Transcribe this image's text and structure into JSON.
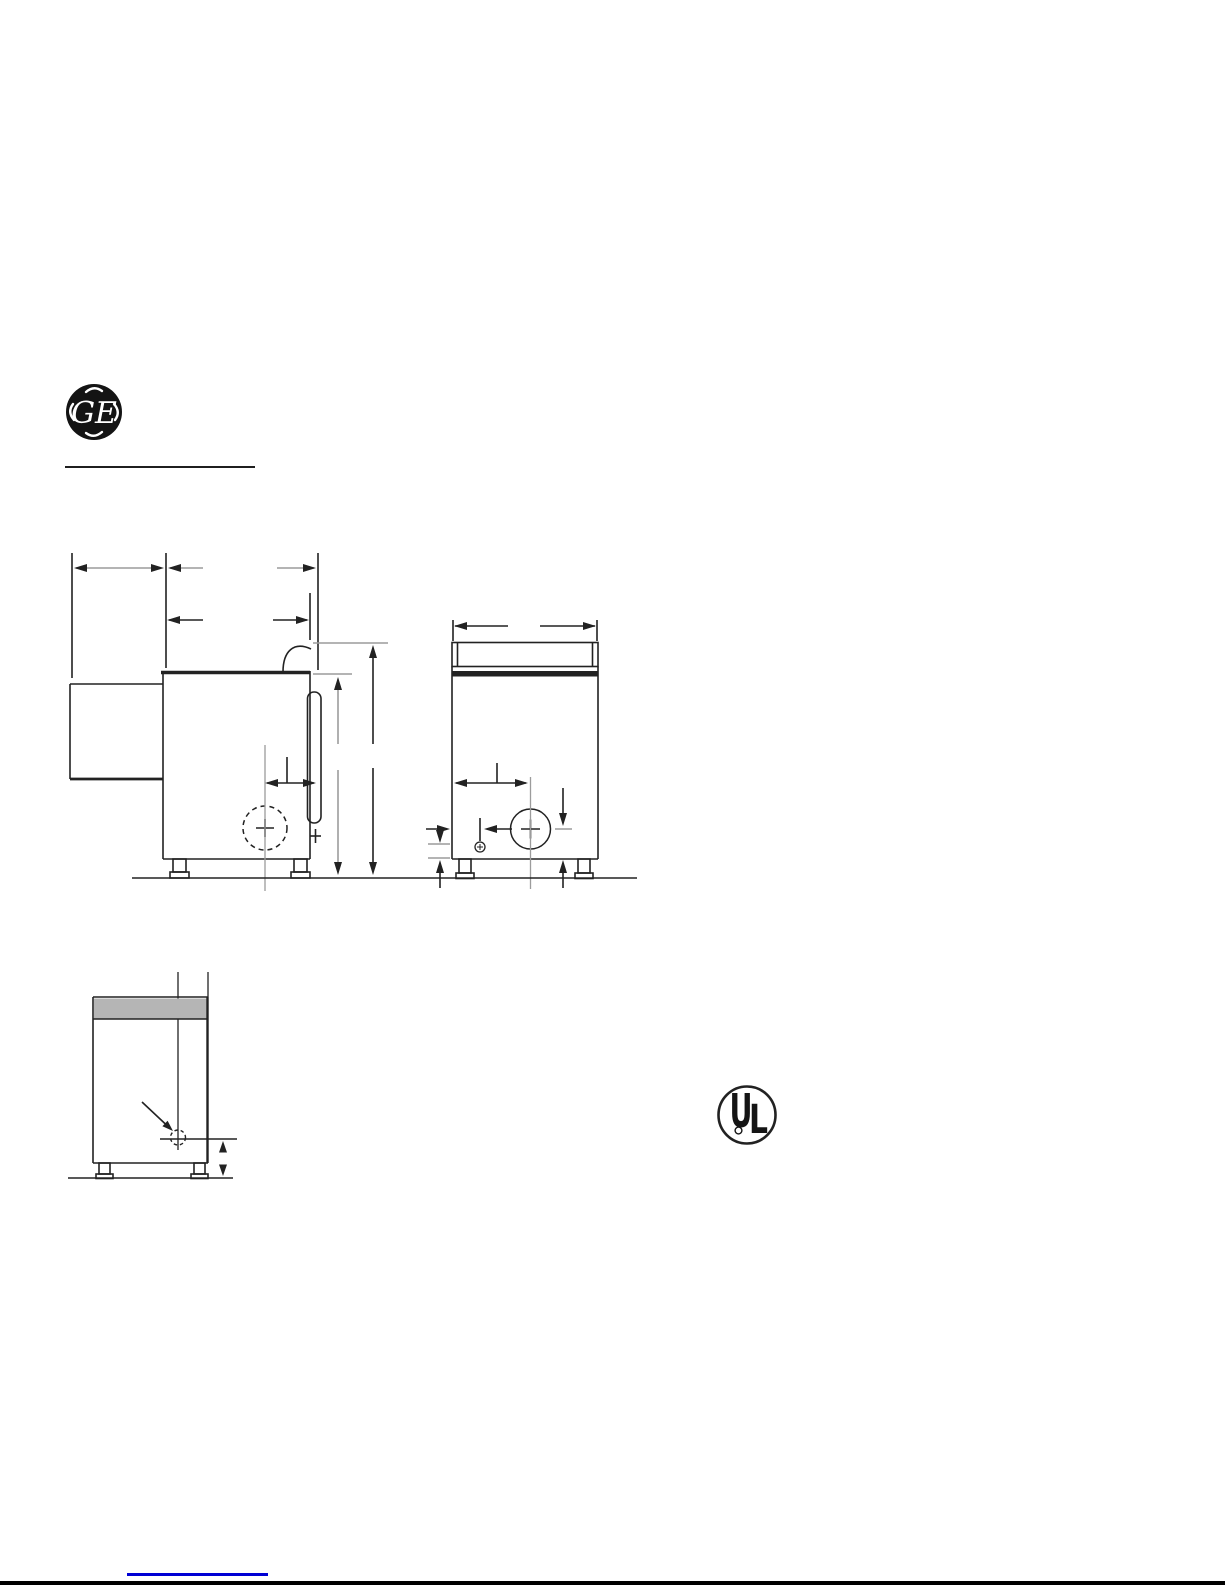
{
  "page": {
    "width": 1225,
    "height": 1585,
    "background": "#ffffff"
  },
  "colors": {
    "ink": "#222222",
    "gray_line": "#9c9c9c",
    "band_fill": "#b5b5b5",
    "link_blue": "#0000d4",
    "logo_black": "#141414",
    "white": "#ffffff"
  },
  "header": {
    "ge_monogram_letters": "GE"
  },
  "certification": {
    "ul_letter_u": "U",
    "ul_letter_l": "L"
  },
  "drawing": {
    "views": [
      {
        "name": "side-view",
        "shapes": [
          {
            "t": "l",
            "x1": 72,
            "y1": 553,
            "x2": 72,
            "y2": 678
          },
          {
            "t": "l",
            "x1": 166,
            "y1": 553,
            "x2": 166,
            "y2": 668
          },
          {
            "t": "l",
            "x1": 318,
            "y1": 553,
            "x2": 318,
            "y2": 670
          },
          {
            "t": "l",
            "x1": 310,
            "y1": 593,
            "x2": 310,
            "y2": 640
          },
          {
            "t": "l",
            "x1": 76,
            "y1": 568,
            "x2": 160,
            "y2": 568,
            "c": "g"
          },
          {
            "t": "a",
            "x": 74,
            "y": 568,
            "dir": "left"
          },
          {
            "t": "a",
            "x": 164,
            "y": 568,
            "dir": "right"
          },
          {
            "t": "l",
            "x1": 170,
            "y1": 568,
            "x2": 203,
            "y2": 568,
            "c": "g"
          },
          {
            "t": "l",
            "x1": 277,
            "y1": 568,
            "x2": 314,
            "y2": 568,
            "c": "g"
          },
          {
            "t": "a",
            "x": 168,
            "y": 568,
            "dir": "left"
          },
          {
            "t": "a",
            "x": 316,
            "y": 568,
            "dir": "right"
          },
          {
            "t": "l",
            "x1": 169,
            "y1": 620,
            "x2": 203,
            "y2": 620
          },
          {
            "t": "l",
            "x1": 273,
            "y1": 620,
            "x2": 307,
            "y2": 620
          },
          {
            "t": "a",
            "x": 167,
            "y": 620,
            "dir": "left"
          },
          {
            "t": "a",
            "x": 309,
            "y": 620,
            "dir": "right"
          },
          {
            "t": "l",
            "x1": 161,
            "y1": 672.5,
            "x2": 310,
            "y2": 672.5,
            "w": 3.4,
            "n": "cabinet-top"
          },
          {
            "t": "l",
            "x1": 163,
            "y1": 671,
            "x2": 163,
            "y2": 859,
            "n": "cabinet-rear-edge"
          },
          {
            "t": "l",
            "x1": 163,
            "y1": 859,
            "x2": 310,
            "y2": 859,
            "n": "cabinet-bottom"
          },
          {
            "t": "l",
            "x1": 310,
            "y1": 671,
            "x2": 310,
            "y2": 859,
            "n": "cabinet-front-edge"
          },
          {
            "t": "l",
            "x1": 70,
            "y1": 684,
            "x2": 163,
            "y2": 684,
            "n": "rear-duct-top"
          },
          {
            "t": "l",
            "x1": 70,
            "y1": 684,
            "x2": 70,
            "y2": 779,
            "n": "rear-duct-left"
          },
          {
            "t": "l",
            "x1": 70,
            "y1": 779,
            "x2": 163,
            "y2": 779,
            "w": 2.8,
            "n": "rear-duct-bottom"
          },
          {
            "t": "p",
            "d": "M 283 672 C 283 651 294 641 311 649",
            "n": "console-profile-arc"
          },
          {
            "t": "r",
            "x": 307.5,
            "y": 692,
            "wd": 13.5,
            "ht": 131,
            "rx": 6.5,
            "n": "door-side-profile"
          },
          {
            "t": "c",
            "cx": 265,
            "cy": 828,
            "r": 22,
            "d": "5 4",
            "n": "exhaust-outlet-dashed-circle"
          },
          {
            "t": "l",
            "x1": 256,
            "y1": 828,
            "x2": 274,
            "y2": 828
          },
          {
            "t": "l",
            "x1": 265,
            "y1": 819,
            "x2": 265,
            "y2": 837
          },
          {
            "t": "l",
            "x1": 265,
            "y1": 745,
            "x2": 265,
            "y2": 891,
            "c": "g",
            "w": 1.3,
            "n": "exhaust-centerline"
          },
          {
            "t": "l",
            "x1": 267,
            "y1": 783,
            "x2": 314,
            "y2": 783
          },
          {
            "t": "a",
            "x": 265,
            "y": 783,
            "dir": "left"
          },
          {
            "t": "a",
            "x": 316,
            "y": 783,
            "dir": "right"
          },
          {
            "t": "l",
            "x1": 287,
            "y1": 757,
            "x2": 287,
            "y2": 783
          },
          {
            "t": "l",
            "x1": 313,
            "y1": 643,
            "x2": 388,
            "y2": 643,
            "c": "g"
          },
          {
            "t": "l",
            "x1": 313,
            "y1": 674,
            "x2": 352,
            "y2": 674,
            "c": "g"
          },
          {
            "t": "l",
            "x1": 338,
            "y1": 688,
            "x2": 338,
            "y2": 744,
            "c": "g"
          },
          {
            "t": "l",
            "x1": 338,
            "y1": 770,
            "x2": 338,
            "y2": 862,
            "c": "g"
          },
          {
            "t": "a",
            "x": 338,
            "y": 677,
            "dir": "up"
          },
          {
            "t": "a",
            "x": 338,
            "y": 875,
            "dir": "down"
          },
          {
            "t": "l",
            "x1": 373,
            "y1": 656,
            "x2": 373,
            "y2": 744
          },
          {
            "t": "l",
            "x1": 373,
            "y1": 768,
            "x2": 373,
            "y2": 862
          },
          {
            "t": "a",
            "x": 373,
            "y": 645,
            "dir": "up"
          },
          {
            "t": "a",
            "x": 373,
            "y": 875,
            "dir": "down"
          },
          {
            "t": "r",
            "x": 173,
            "y": 859,
            "wd": 13,
            "ht": 13,
            "n": "leg"
          },
          {
            "t": "r",
            "x": 170,
            "y": 872,
            "wd": 19,
            "ht": 6,
            "n": "leg-foot"
          },
          {
            "t": "r",
            "x": 294,
            "y": 859,
            "wd": 13,
            "ht": 13,
            "n": "leg"
          },
          {
            "t": "r",
            "x": 291,
            "y": 872,
            "wd": 19,
            "ht": 6,
            "n": "leg-foot"
          },
          {
            "t": "l",
            "x1": 310,
            "y1": 836,
            "x2": 321,
            "y2": 836,
            "n": "gas-stub"
          },
          {
            "t": "l",
            "x1": 315.5,
            "y1": 829,
            "x2": 315.5,
            "y2": 843,
            "n": "gas-stub"
          }
        ]
      },
      {
        "name": "front-view",
        "shapes": [
          {
            "t": "l",
            "x1": 453,
            "y1": 620,
            "x2": 453,
            "y2": 641
          },
          {
            "t": "l",
            "x1": 597,
            "y1": 620,
            "x2": 597,
            "y2": 641
          },
          {
            "t": "l",
            "x1": 455,
            "y1": 626,
            "x2": 508,
            "y2": 626
          },
          {
            "t": "l",
            "x1": 540,
            "y1": 626,
            "x2": 595,
            "y2": 626
          },
          {
            "t": "a",
            "x": 454,
            "y": 626,
            "dir": "left"
          },
          {
            "t": "a",
            "x": 596,
            "y": 626,
            "dir": "right"
          },
          {
            "t": "r",
            "x": 452,
            "y": 642.5,
            "wd": 146,
            "ht": 24,
            "n": "backsplash"
          },
          {
            "t": "l",
            "x1": 457.5,
            "y1": 643,
            "x2": 457.5,
            "y2": 666
          },
          {
            "t": "l",
            "x1": 592.5,
            "y1": 643,
            "x2": 592.5,
            "y2": 666
          },
          {
            "t": "r",
            "x": 452,
            "y": 671,
            "wd": 146,
            "ht": 5.5,
            "fill": "ink",
            "n": "top-edge-band"
          },
          {
            "t": "l",
            "x1": 452,
            "y1": 666.5,
            "x2": 452,
            "y2": 859,
            "n": "cabinet-left-edge"
          },
          {
            "t": "l",
            "x1": 598,
            "y1": 666.5,
            "x2": 598,
            "y2": 859,
            "n": "cabinet-right-edge"
          },
          {
            "t": "l",
            "x1": 452,
            "y1": 859,
            "x2": 598,
            "y2": 859,
            "n": "cabinet-bottom"
          },
          {
            "t": "l",
            "x1": 456,
            "y1": 783,
            "x2": 526,
            "y2": 783
          },
          {
            "t": "a",
            "x": 454,
            "y": 783,
            "dir": "left"
          },
          {
            "t": "a",
            "x": 528,
            "y": 783,
            "dir": "right"
          },
          {
            "t": "l",
            "x1": 497,
            "y1": 763,
            "x2": 497,
            "y2": 783
          },
          {
            "t": "c",
            "cx": 530.5,
            "cy": 829,
            "r": 20,
            "n": "exhaust-outlet-circle"
          },
          {
            "t": "l",
            "x1": 521,
            "y1": 829,
            "x2": 540,
            "y2": 829
          },
          {
            "t": "l",
            "x1": 530.5,
            "y1": 819.5,
            "x2": 530.5,
            "y2": 838.5
          },
          {
            "t": "l",
            "x1": 530.5,
            "y1": 777,
            "x2": 530.5,
            "y2": 889,
            "c": "g",
            "w": 1.3,
            "n": "center-line"
          },
          {
            "t": "l",
            "x1": 563,
            "y1": 788,
            "x2": 563,
            "y2": 815
          },
          {
            "t": "a",
            "x": 563,
            "y": 826,
            "dir": "down"
          },
          {
            "t": "l",
            "x1": 555,
            "y1": 829,
            "x2": 572,
            "y2": 829,
            "c": "g"
          },
          {
            "t": "l",
            "x1": 487,
            "y1": 829,
            "x2": 512,
            "y2": 829
          },
          {
            "t": "a",
            "x": 484,
            "y": 829,
            "dir": "left"
          },
          {
            "t": "l",
            "x1": 480,
            "y1": 818,
            "x2": 480,
            "y2": 841
          },
          {
            "t": "c",
            "cx": 480,
            "cy": 847,
            "r": 5,
            "w": 1.3,
            "n": "gas-connection-circle"
          },
          {
            "t": "l",
            "x1": 477,
            "y1": 847,
            "x2": 483,
            "y2": 847,
            "w": 1
          },
          {
            "t": "l",
            "x1": 480,
            "y1": 844,
            "x2": 480,
            "y2": 850,
            "w": 1
          },
          {
            "t": "l",
            "x1": 426,
            "y1": 829,
            "x2": 447,
            "y2": 829
          },
          {
            "t": "a",
            "x": 450,
            "y": 829,
            "dir": "right"
          },
          {
            "t": "l",
            "x1": 428,
            "y1": 844,
            "x2": 450,
            "y2": 844,
            "c": "g"
          },
          {
            "t": "l",
            "x1": 440,
            "y1": 830,
            "x2": 440,
            "y2": 834
          },
          {
            "t": "a",
            "x": 440,
            "y": 843,
            "dir": "down"
          },
          {
            "t": "l",
            "x1": 428,
            "y1": 858,
            "x2": 450,
            "y2": 858,
            "c": "g"
          },
          {
            "t": "l",
            "x1": 440,
            "y1": 888,
            "x2": 440,
            "y2": 864
          },
          {
            "t": "a",
            "x": 440,
            "y": 860,
            "dir": "up"
          },
          {
            "t": "r",
            "x": 459,
            "y": 859,
            "wd": 12,
            "ht": 14,
            "n": "leg"
          },
          {
            "t": "r",
            "x": 456,
            "y": 873,
            "wd": 18,
            "ht": 5.5,
            "n": "leg-foot"
          },
          {
            "t": "r",
            "x": 578,
            "y": 859,
            "wd": 12,
            "ht": 14,
            "n": "leg"
          },
          {
            "t": "r",
            "x": 575,
            "y": 873,
            "wd": 18,
            "ht": 5.5,
            "n": "leg-foot"
          },
          {
            "t": "l",
            "x1": 563,
            "y1": 888,
            "x2": 563,
            "y2": 864
          },
          {
            "t": "a",
            "x": 563,
            "y": 860,
            "dir": "up"
          }
        ]
      },
      {
        "name": "rear-view",
        "shapes": [
          {
            "t": "l",
            "x1": 178,
            "y1": 972,
            "x2": 178,
            "y2": 1150,
            "w": 1.3,
            "n": "center-line"
          },
          {
            "t": "l",
            "x1": 208,
            "y1": 972,
            "x2": 208,
            "y2": 997,
            "w": 1.3
          },
          {
            "t": "r",
            "x": 94,
            "y": 998.5,
            "wd": 113,
            "ht": 20,
            "fill": "band",
            "n": "top-shaded-band"
          },
          {
            "t": "l",
            "x1": 93,
            "y1": 997,
            "x2": 207.5,
            "y2": 997
          },
          {
            "t": "l",
            "x1": 93,
            "y1": 1019,
            "x2": 207.5,
            "y2": 1019
          },
          {
            "t": "l",
            "x1": 93,
            "y1": 997,
            "x2": 93,
            "y2": 1163,
            "n": "cabinet-left-edge"
          },
          {
            "t": "l",
            "x1": 93,
            "y1": 1163,
            "x2": 208,
            "y2": 1163,
            "n": "cabinet-bottom"
          },
          {
            "t": "l",
            "x1": 207.5,
            "y1": 997,
            "x2": 207.5,
            "y2": 1163,
            "w": 2.4,
            "n": "cabinet-right-edge"
          },
          {
            "t": "l",
            "x1": 142,
            "y1": 1102,
            "x2": 167,
            "y2": 1125.5,
            "n": "pointer-arrow"
          },
          {
            "t": "g",
            "pts": "173,1131 162.4,1126.3 167.6,1120.7",
            "n": "pointer-arrowhead"
          },
          {
            "t": "c",
            "cx": 178,
            "cy": 1137.5,
            "r": 7.5,
            "d": "3.5 2.8",
            "w": 1.4,
            "n": "inlet-dashed-circle"
          },
          {
            "t": "l",
            "x1": 160,
            "y1": 1139,
            "x2": 237,
            "y2": 1139
          },
          {
            "t": "g",
            "pts": "223,1141 219,1152.5 227,1152.5",
            "n": "up-arrowhead"
          },
          {
            "t": "g",
            "pts": "223,1176 219,1164.5 227,1164.5",
            "n": "down-arrowhead"
          },
          {
            "t": "r",
            "x": 99,
            "y": 1163,
            "wd": 11,
            "ht": 11,
            "n": "leg"
          },
          {
            "t": "r",
            "x": 96,
            "y": 1174,
            "wd": 17,
            "ht": 4.5,
            "n": "leg-foot"
          },
          {
            "t": "r",
            "x": 194,
            "y": 1163,
            "wd": 11,
            "ht": 11,
            "n": "leg"
          },
          {
            "t": "r",
            "x": 191,
            "y": 1174,
            "wd": 17,
            "ht": 4.5,
            "n": "leg-foot"
          },
          {
            "t": "l",
            "x1": 68,
            "y1": 1178,
            "x2": 233,
            "y2": 1178,
            "n": "floor-line"
          }
        ]
      },
      {
        "name": "ground-line",
        "shapes": [
          {
            "t": "l",
            "x1": 132,
            "y1": 878,
            "x2": 637,
            "y2": 878,
            "n": "floor-line"
          }
        ]
      }
    ]
  }
}
